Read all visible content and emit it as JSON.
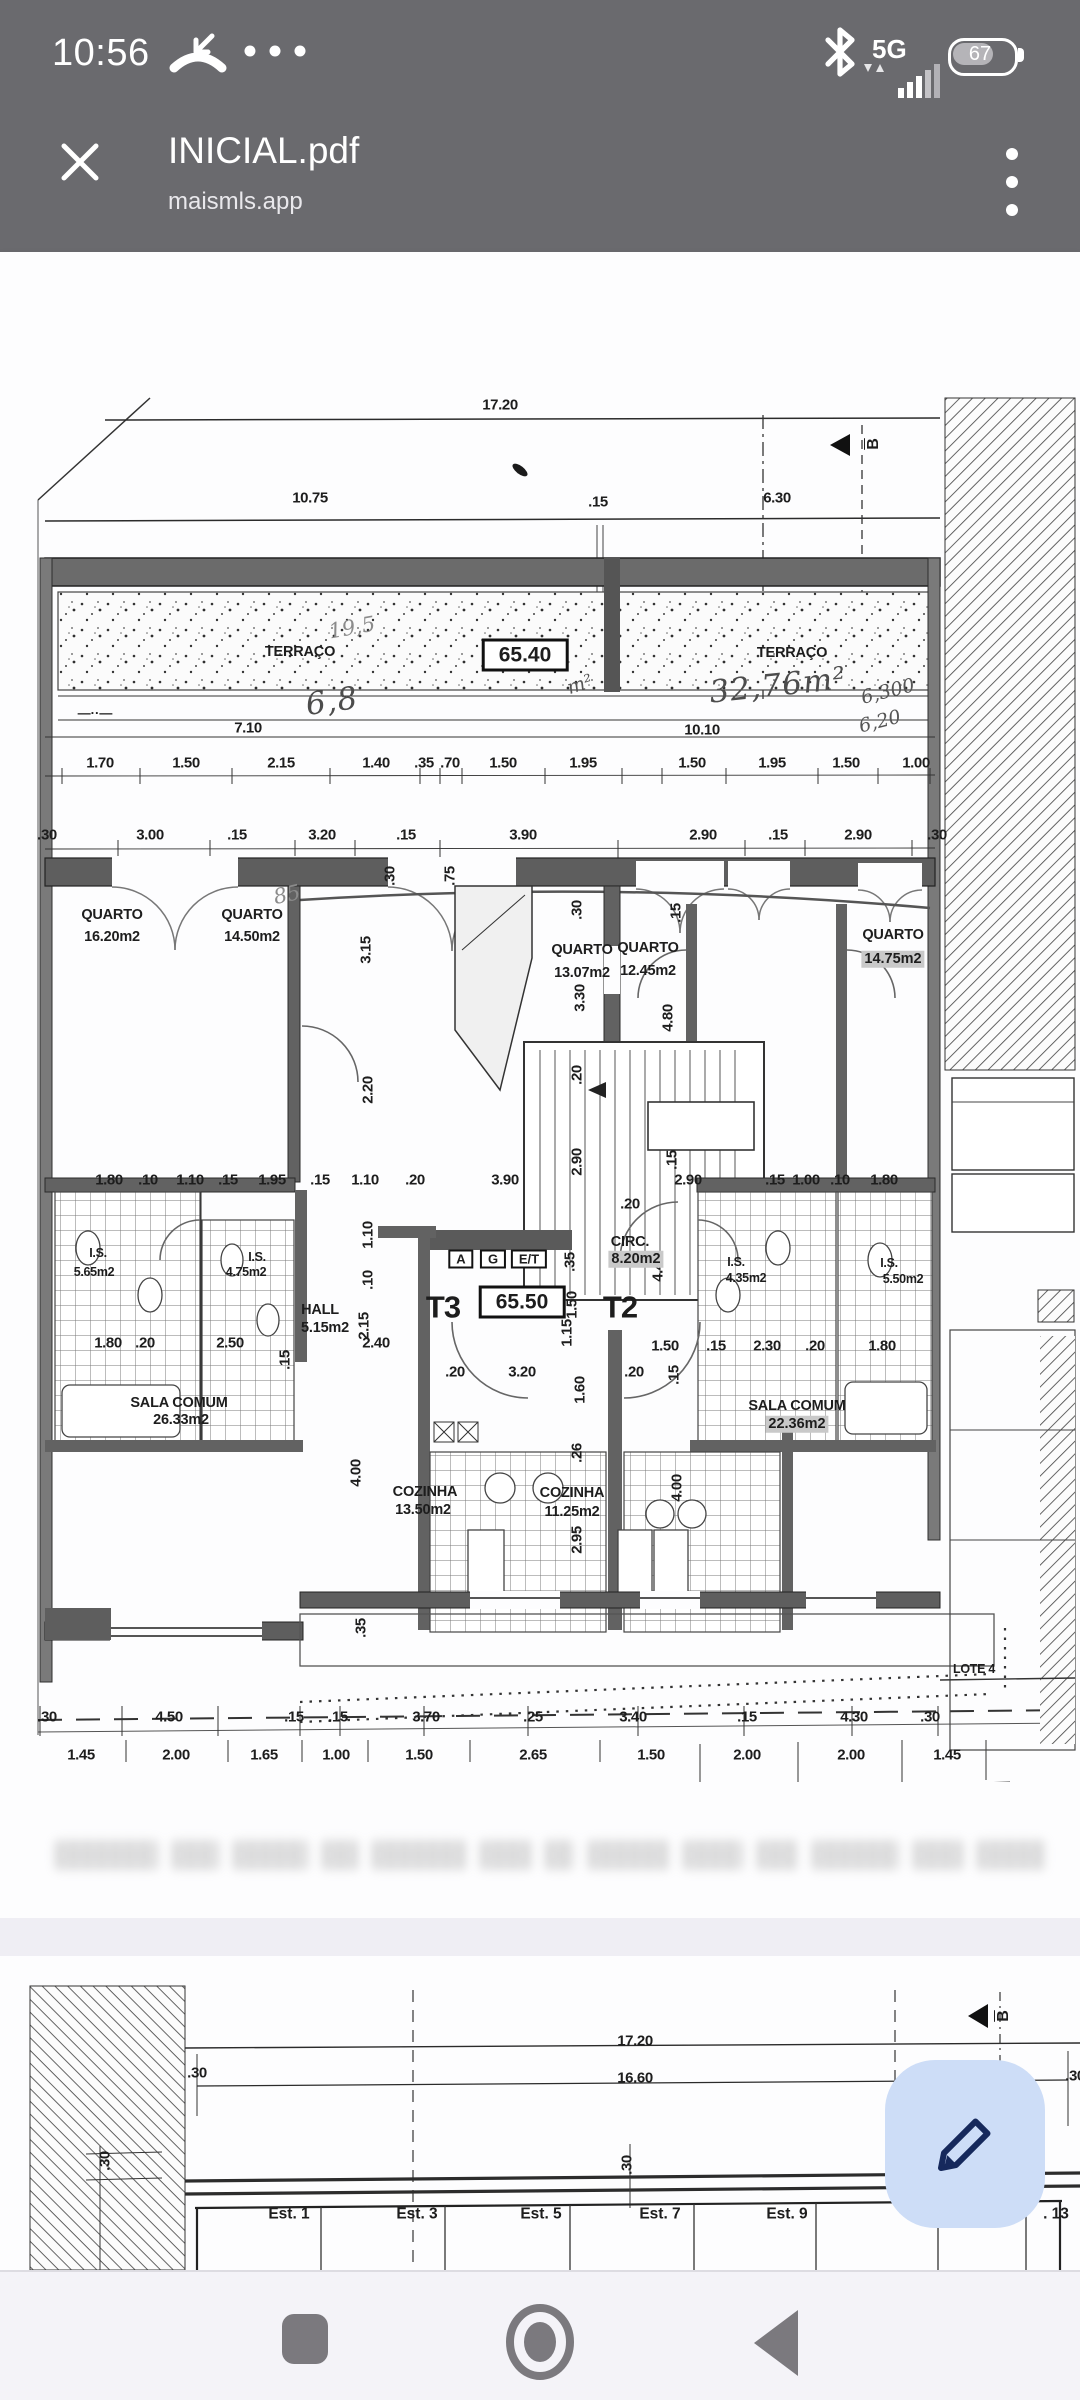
{
  "status_bar": {
    "time": "10:56",
    "network_label": "5G",
    "battery_level": "67",
    "icons": [
      "missed-call-icon",
      "ellipsis-icon",
      "bluetooth-icon",
      "signal-bars-icon",
      "battery-icon"
    ]
  },
  "header": {
    "title": "INICIAL.pdf",
    "subtitle": "maismls.app",
    "icons": [
      "close-icon",
      "kebab-menu-icon"
    ]
  },
  "colors": {
    "bar_bg": "#6a6a6e",
    "page_bg": "#fdfdfe",
    "gap_bg": "#efeef4",
    "nav_bg": "#f4f3f8",
    "nav_icon": "#7b797e",
    "fab_bg": "#cdddf7",
    "fab_icon": "#16295c",
    "ink": "#1d1d1d"
  },
  "fab": {
    "icon": "pencil-icon"
  },
  "nav": {
    "icons": [
      "recents-icon",
      "home-icon",
      "back-icon"
    ]
  },
  "page1": {
    "labels": [
      {
        "t": "17.20",
        "x": 500,
        "y": 15
      },
      {
        "t": "10.75",
        "x": 310,
        "y": 108
      },
      {
        "t": ".15",
        "x": 598,
        "y": 112
      },
      {
        "t": "6.30",
        "x": 777,
        "y": 108
      },
      {
        "t": "B",
        "x": 874,
        "y": 54,
        "r": -90,
        "s": "secb"
      },
      {
        "t": "TERRAÇO",
        "x": 300,
        "y": 262,
        "s": "room"
      },
      {
        "t": "19,5",
        "x": 352,
        "y": 238,
        "r": -10,
        "s": "hand"
      },
      {
        "t": "65.40",
        "x": 525,
        "y": 265,
        "s": "boxed"
      },
      {
        "t": "m²",
        "x": 580,
        "y": 295,
        "r": -18,
        "s": "handdk"
      },
      {
        "t": "6,8",
        "x": 332,
        "y": 312,
        "r": -8,
        "s": "handbig"
      },
      {
        "t": "TERRAÇO",
        "x": 792,
        "y": 263,
        "s": "room"
      },
      {
        "t": "32,76m²",
        "x": 778,
        "y": 296,
        "r": -6,
        "s": "handbig"
      },
      {
        "t": "6,300",
        "x": 888,
        "y": 302,
        "r": -14,
        "s": "handdk"
      },
      {
        "t": "6,20",
        "x": 880,
        "y": 332,
        "r": -14,
        "s": "handdk"
      },
      {
        "t": "7.10",
        "x": 248,
        "y": 338
      },
      {
        "t": "10.10",
        "x": 702,
        "y": 340
      },
      {
        "t": "—··—",
        "x": 95,
        "y": 323,
        "s": "sym"
      },
      {
        "t": "1.70",
        "x": 100,
        "y": 373
      },
      {
        "t": "1.50",
        "x": 186,
        "y": 373
      },
      {
        "t": "2.15",
        "x": 281,
        "y": 373
      },
      {
        "t": "1.40",
        "x": 376,
        "y": 373
      },
      {
        "t": ".35",
        "x": 424,
        "y": 373
      },
      {
        "t": ".70",
        "x": 450,
        "y": 373
      },
      {
        "t": "1.50",
        "x": 503,
        "y": 373
      },
      {
        "t": "1.95",
        "x": 583,
        "y": 373
      },
      {
        "t": "1.50",
        "x": 692,
        "y": 373
      },
      {
        "t": "1.95",
        "x": 772,
        "y": 373
      },
      {
        "t": "1.50",
        "x": 846,
        "y": 373
      },
      {
        "t": "1.00",
        "x": 916,
        "y": 373
      },
      {
        "t": ".30",
        "x": 47,
        "y": 445
      },
      {
        "t": "3.00",
        "x": 150,
        "y": 445
      },
      {
        "t": ".15",
        "x": 237,
        "y": 445
      },
      {
        "t": "3.20",
        "x": 322,
        "y": 445
      },
      {
        "t": ".15",
        "x": 406,
        "y": 445
      },
      {
        "t": "3.90",
        "x": 523,
        "y": 445
      },
      {
        "t": "2.90",
        "x": 703,
        "y": 445
      },
      {
        "t": ".15",
        "x": 778,
        "y": 445
      },
      {
        "t": "2.90",
        "x": 858,
        "y": 445
      },
      {
        "t": ".30",
        "x": 937,
        "y": 445
      },
      {
        "t": "85",
        "x": 287,
        "y": 505,
        "r": -12,
        "s": "hand"
      },
      {
        "t": "QUARTO",
        "x": 112,
        "y": 525,
        "s": "room"
      },
      {
        "t": "16.20m2",
        "x": 112,
        "y": 547,
        "s": "room"
      },
      {
        "t": "QUARTO",
        "x": 252,
        "y": 525,
        "s": "room"
      },
      {
        "t": "14.50m2",
        "x": 252,
        "y": 547,
        "s": "room"
      },
      {
        "t": "QUARTO",
        "x": 582,
        "y": 560,
        "s": "room"
      },
      {
        "t": "13.07m2",
        "x": 582,
        "y": 583,
        "s": "room"
      },
      {
        "t": "QUARTO",
        "x": 648,
        "y": 558,
        "s": "room"
      },
      {
        "t": "12.45m2",
        "x": 648,
        "y": 581,
        "s": "room"
      },
      {
        "t": "QUARTO",
        "x": 893,
        "y": 545,
        "s": "room"
      },
      {
        "t": "14.75m2",
        "x": 893,
        "y": 569,
        "s": "rmhl"
      },
      {
        "t": ".30",
        "x": 390,
        "y": 486,
        "r": -90
      },
      {
        "t": ".75",
        "x": 450,
        "y": 486,
        "r": -90
      },
      {
        "t": "3.15",
        "x": 366,
        "y": 560,
        "r": -90
      },
      {
        "t": ".30",
        "x": 577,
        "y": 520,
        "r": -90
      },
      {
        "t": ".15",
        "x": 676,
        "y": 523,
        "r": -90
      },
      {
        "t": "3.30",
        "x": 580,
        "y": 608,
        "r": -90
      },
      {
        "t": "4.80",
        "x": 668,
        "y": 628,
        "r": -90
      },
      {
        "t": "2.20",
        "x": 368,
        "y": 700,
        "r": -90
      },
      {
        "t": ".20",
        "x": 577,
        "y": 685,
        "r": -90
      },
      {
        "t": "2.90",
        "x": 577,
        "y": 772,
        "r": -90
      },
      {
        "t": ".15",
        "x": 672,
        "y": 770,
        "r": -90
      },
      {
        "t": "1.80",
        "x": 109,
        "y": 790
      },
      {
        "t": ".10",
        "x": 148,
        "y": 790
      },
      {
        "t": "1.10",
        "x": 190,
        "y": 790
      },
      {
        "t": ".15",
        "x": 228,
        "y": 790
      },
      {
        "t": "1.95",
        "x": 272,
        "y": 790
      },
      {
        "t": ".15",
        "x": 320,
        "y": 790
      },
      {
        "t": "1.10",
        "x": 365,
        "y": 790
      },
      {
        "t": ".20",
        "x": 415,
        "y": 790
      },
      {
        "t": "3.90",
        "x": 505,
        "y": 790
      },
      {
        "t": "2.90",
        "x": 688,
        "y": 790
      },
      {
        "t": ".15",
        "x": 775,
        "y": 790
      },
      {
        "t": "1.00",
        "x": 806,
        "y": 790
      },
      {
        "t": ".10",
        "x": 840,
        "y": 790
      },
      {
        "t": "1.80",
        "x": 884,
        "y": 790
      },
      {
        "t": ".20",
        "x": 630,
        "y": 814
      },
      {
        "t": "1.10",
        "x": 368,
        "y": 845,
        "r": -90
      },
      {
        "t": ".10",
        "x": 368,
        "y": 890,
        "r": -90
      },
      {
        "t": "2.15",
        "x": 364,
        "y": 936,
        "r": -90
      },
      {
        "t": ".35",
        "x": 570,
        "y": 872,
        "r": -90
      },
      {
        "t": "4.45",
        "x": 658,
        "y": 878,
        "r": -90
      },
      {
        "t": "1.50",
        "x": 572,
        "y": 915,
        "r": -90
      },
      {
        "t": "1.15",
        "x": 567,
        "y": 943,
        "r": -90
      },
      {
        "t": "CIRC.",
        "x": 630,
        "y": 852,
        "s": "room"
      },
      {
        "t": "8.20m2",
        "x": 636,
        "y": 869,
        "s": "rmhl"
      },
      {
        "t": "I.S.",
        "x": 98,
        "y": 863,
        "s": "tiny"
      },
      {
        "t": "5.65m2",
        "x": 94,
        "y": 882,
        "s": "tiny"
      },
      {
        "t": "I.S.",
        "x": 257,
        "y": 867,
        "s": "tiny"
      },
      {
        "t": "4.75m2",
        "x": 246,
        "y": 882,
        "s": "tiny"
      },
      {
        "t": "I.S.",
        "x": 736,
        "y": 872,
        "s": "tiny"
      },
      {
        "t": "4.35m2",
        "x": 746,
        "y": 888,
        "s": "tiny"
      },
      {
        "t": "I.S.",
        "x": 889,
        "y": 873,
        "s": "tiny"
      },
      {
        "t": "5.50m2",
        "x": 903,
        "y": 889,
        "s": "tiny"
      },
      {
        "t": "HALL",
        "x": 320,
        "y": 920,
        "s": "room"
      },
      {
        "t": "5.15m2",
        "x": 325,
        "y": 938,
        "s": "room"
      },
      {
        "t": "A",
        "x": 461,
        "y": 869,
        "s": "boxsm"
      },
      {
        "t": "G",
        "x": 493,
        "y": 869,
        "s": "boxsm"
      },
      {
        "t": "E/T",
        "x": 529,
        "y": 869,
        "s": "boxsm"
      },
      {
        "t": "T3",
        "x": 443,
        "y": 917,
        "s": "big"
      },
      {
        "t": "65.50",
        "x": 522,
        "y": 912,
        "s": "boxed"
      },
      {
        "t": "T2",
        "x": 620,
        "y": 917,
        "s": "big"
      },
      {
        "t": "1.80",
        "x": 108,
        "y": 953
      },
      {
        "t": ".20",
        "x": 145,
        "y": 953
      },
      {
        "t": "2.50",
        "x": 230,
        "y": 953
      },
      {
        "t": "2.40",
        "x": 376,
        "y": 953
      },
      {
        "t": "1.50",
        "x": 665,
        "y": 956
      },
      {
        "t": ".15",
        "x": 716,
        "y": 956
      },
      {
        "t": "2.30",
        "x": 767,
        "y": 956
      },
      {
        "t": ".20",
        "x": 815,
        "y": 956
      },
      {
        "t": "1.80",
        "x": 882,
        "y": 956
      },
      {
        "t": ".15",
        "x": 285,
        "y": 970,
        "r": -90
      },
      {
        "t": ".20",
        "x": 455,
        "y": 982
      },
      {
        "t": "3.20",
        "x": 522,
        "y": 982
      },
      {
        "t": ".20",
        "x": 634,
        "y": 982
      },
      {
        "t": "1.60",
        "x": 580,
        "y": 1000,
        "r": -90
      },
      {
        "t": ".15",
        "x": 674,
        "y": 985,
        "r": -90
      },
      {
        "t": "SALA COMUM",
        "x": 179,
        "y": 1013,
        "s": "room"
      },
      {
        "t": "26.33m2",
        "x": 181,
        "y": 1030,
        "s": "room"
      },
      {
        "t": "SALA COMUM",
        "x": 797,
        "y": 1016,
        "s": "room"
      },
      {
        "t": "22.36m2",
        "x": 797,
        "y": 1034,
        "s": "rmhl"
      },
      {
        "t": "4.00",
        "x": 356,
        "y": 1083,
        "r": -90
      },
      {
        "t": ".26",
        "x": 577,
        "y": 1063,
        "r": -90
      },
      {
        "t": "4.00",
        "x": 677,
        "y": 1098,
        "r": -90
      },
      {
        "t": "2.95",
        "x": 577,
        "y": 1150,
        "r": -90
      },
      {
        "t": "COZINHA",
        "x": 425,
        "y": 1102,
        "s": "room"
      },
      {
        "t": "13.50m2",
        "x": 423,
        "y": 1120,
        "s": "room"
      },
      {
        "t": "COZINHA",
        "x": 572,
        "y": 1103,
        "s": "room"
      },
      {
        "t": "11.25m2",
        "x": 572,
        "y": 1122,
        "s": "room"
      },
      {
        "t": ".35",
        "x": 361,
        "y": 1238,
        "r": -90
      },
      {
        "t": "LOTE 4",
        "x": 974,
        "y": 1279,
        "s": "tiny"
      },
      {
        "t": ".30",
        "x": 47,
        "y": 1327
      },
      {
        "t": "4.50",
        "x": 169,
        "y": 1327
      },
      {
        "t": ".15",
        "x": 294,
        "y": 1327
      },
      {
        "t": ".15",
        "x": 338,
        "y": 1327
      },
      {
        "t": "3.70",
        "x": 426,
        "y": 1327
      },
      {
        "t": ".25",
        "x": 533,
        "y": 1327
      },
      {
        "t": "3.40",
        "x": 633,
        "y": 1327
      },
      {
        "t": ".15",
        "x": 747,
        "y": 1327
      },
      {
        "t": "4.30",
        "x": 854,
        "y": 1327
      },
      {
        "t": ".30",
        "x": 930,
        "y": 1327
      },
      {
        "t": "1.45",
        "x": 81,
        "y": 1365
      },
      {
        "t": "2.00",
        "x": 176,
        "y": 1365
      },
      {
        "t": "1.65",
        "x": 264,
        "y": 1365
      },
      {
        "t": "1.00",
        "x": 336,
        "y": 1365
      },
      {
        "t": "1.50",
        "x": 419,
        "y": 1365
      },
      {
        "t": "2.65",
        "x": 533,
        "y": 1365
      },
      {
        "t": "1.50",
        "x": 651,
        "y": 1365
      },
      {
        "t": "2.00",
        "x": 747,
        "y": 1365
      },
      {
        "t": "2.00",
        "x": 851,
        "y": 1365
      },
      {
        "t": "1.45",
        "x": 947,
        "y": 1365
      }
    ]
  },
  "page2": {
    "labels": [
      {
        "t": "17.20",
        "x": 635,
        "y": 85
      },
      {
        "t": "16.60",
        "x": 635,
        "y": 122
      },
      {
        "t": ".30",
        "x": 197,
        "y": 117
      },
      {
        "t": ".30",
        "x": 1075,
        "y": 120
      },
      {
        "t": "B",
        "x": 1004,
        "y": 60,
        "r": -90,
        "s": "secb"
      },
      {
        "t": ".30",
        "x": 105,
        "y": 205,
        "r": -90
      },
      {
        "t": ".30",
        "x": 627,
        "y": 209,
        "r": -90
      },
      {
        "t": "Est. 1",
        "x": 289,
        "y": 258,
        "s": "est"
      },
      {
        "t": "Est. 3",
        "x": 417,
        "y": 258,
        "s": "est"
      },
      {
        "t": "Est. 5",
        "x": 541,
        "y": 258,
        "s": "est"
      },
      {
        "t": "Est. 7",
        "x": 660,
        "y": 258,
        "s": "est"
      },
      {
        "t": "Est. 9",
        "x": 787,
        "y": 258,
        "s": "est"
      },
      {
        "t": ". 13",
        "x": 1056,
        "y": 258,
        "s": "est"
      }
    ]
  }
}
